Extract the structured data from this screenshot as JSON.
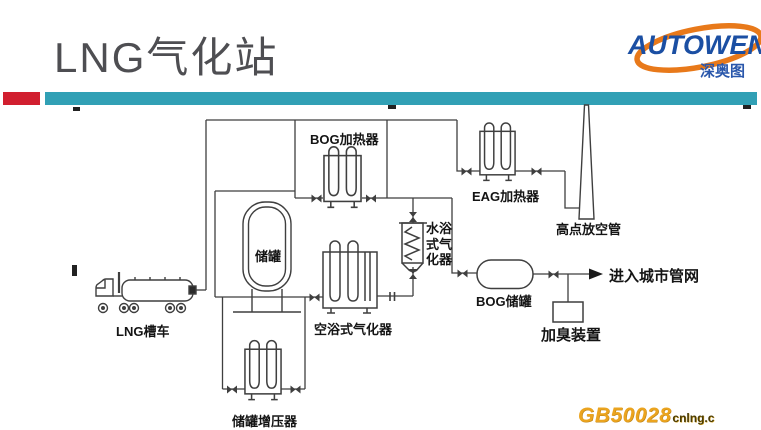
{
  "slide": {
    "title": "LNG气化站"
  },
  "logo": {
    "brand": "AUTOWEN",
    "subtitle": "深奥图",
    "brand_color": "#1b4fa3",
    "swoosh_color": "#e8791a"
  },
  "accent": {
    "red": "#d11f2f",
    "teal": "#31a0b5"
  },
  "diagram": {
    "labels": {
      "lng_truck": "LNG槽车",
      "storage_tank": "储罐",
      "bog_heater": "BOG加热器",
      "eag_heater": "EAG加热器",
      "vent_stack": "高点放空管",
      "water_bath_vaporizer": "水浴式气化器",
      "air_bath_vaporizer": "空浴式气化器",
      "tank_pressurizer": "储罐增压器",
      "bog_tank": "BOG储罐",
      "odorizer": "加臭装置",
      "city_network": "进入城市管网"
    },
    "watermark": {
      "code": "GB50028",
      "suffix": "cnlng.c"
    }
  }
}
